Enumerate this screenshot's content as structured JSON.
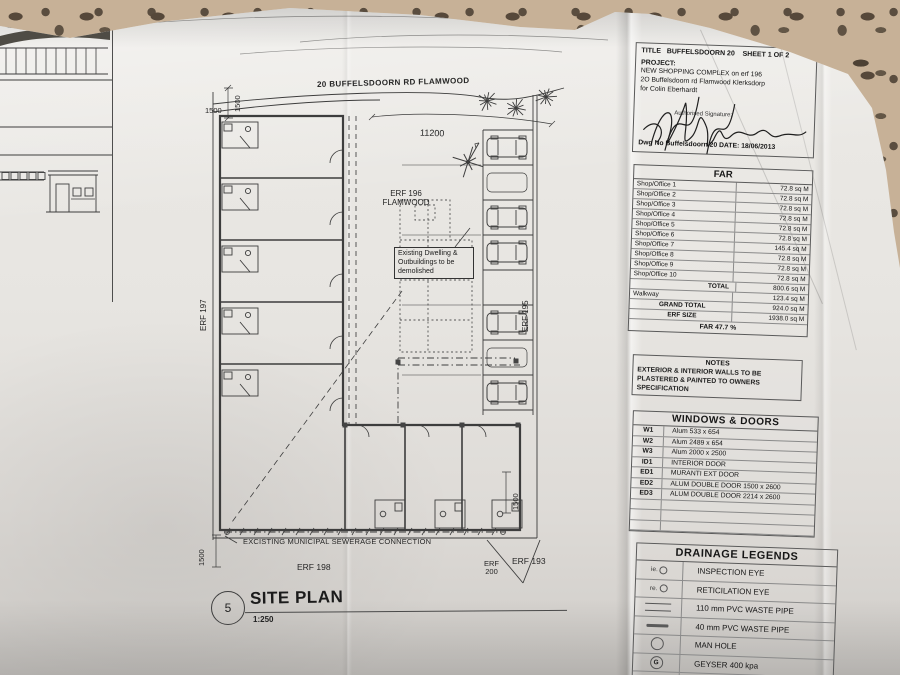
{
  "photo": {
    "handwritten_note": "910/6"
  },
  "plan": {
    "road_label": "20 BUFFELSDOORN RD FLAMWOOD",
    "dim_top": "11200",
    "dim_1500": "1500",
    "erf196_line1": "ERF 196",
    "erf196_line2": "FLAMWOOD",
    "erf197": "ERF 197",
    "erf195": "ERF 195",
    "erf198": "ERF 198",
    "erf200_line1": "ERF",
    "erf200_line2": "200",
    "erf193": "ERF 193",
    "demolish_lines": [
      "Existing Dwelling &",
      "Outbuildings to be",
      "demolished"
    ],
    "sewer_label": "EXCISTING MUNICIPAL SEWERAGE CONNECTION",
    "sheet_circle": "5",
    "title": "SITE PLAN",
    "scale": "1:250"
  },
  "title_block": {
    "title_line": "TITLE   BUFFELSDOORN 20    SHEET 1 OF 2",
    "project_label": "PROJECT:",
    "project_lines": [
      "NEW SHOPPING COMPLEX on erf 196",
      "2O Buffelsdoorn rd Flamwood  Klerksdorp",
      "for Colin Eberhardt"
    ],
    "auth_label": "Authorised Signature:",
    "dwg_line": "Dwg No Buffelsdoorn 20  DATE: 18/06/2013",
    "far": {
      "header": "FAR",
      "rows": [
        {
          "label": "Shop/Office 1",
          "value": "72.8 sq M",
          "style": "item"
        },
        {
          "label": "Shop/Office 2",
          "value": "72.8 sq M",
          "style": "item"
        },
        {
          "label": "Shop/Office 3",
          "value": "72.8 sq M",
          "style": "item"
        },
        {
          "label": "Shop/Office 4",
          "value": "72.8 sq M",
          "style": "item"
        },
        {
          "label": "Shop/Office 5",
          "value": "72.8 sq M",
          "style": "item"
        },
        {
          "label": "Shop/Office 6",
          "value": "72.8 sq M",
          "style": "item"
        },
        {
          "label": "Shop/Office 7",
          "value": "145.4 sq M",
          "style": "item"
        },
        {
          "label": "Shop/Office 8",
          "value": "72.8 sq M",
          "style": "item"
        },
        {
          "label": "Shop/Office 9",
          "value": "72.8 sq M",
          "style": "item"
        },
        {
          "label": "Shop/Office 10",
          "value": "72.8 sq M",
          "style": "item"
        },
        {
          "label": "TOTAL",
          "value": "800.6 sq M",
          "style": "total"
        },
        {
          "label": "Walkway",
          "value": "123.4 sq M",
          "style": "item"
        },
        {
          "label": "GRAND TOTAL",
          "value": "924.0 sq M",
          "style": "center"
        },
        {
          "label": "ERF SIZE",
          "value": "1938.0 sq M",
          "style": "center"
        }
      ],
      "footer": "FAR 47.7 %"
    },
    "notes": {
      "header": "NOTES",
      "lines": [
        "EXTERIOR & INTERIOR WALLS  TO BE",
        "PLASTERED & PAINTED TO OWNERS",
        "SPECIFICATION"
      ]
    },
    "windows_doors": {
      "header": "WINDOWS & DOORS",
      "rows": [
        {
          "code": "W1",
          "desc": "Alum 533 x 654"
        },
        {
          "code": "W2",
          "desc": "Alum 2489 x 654"
        },
        {
          "code": "W3",
          "desc": "Alum 2000 x 2500"
        },
        {
          "code": "ID1",
          "desc": "INTERIOR DOOR"
        },
        {
          "code": "ED1",
          "desc": "MURANTI EXT DOOR"
        },
        {
          "code": "ED2",
          "desc": "ALUM DOUBLE DOOR 1500 x 2600"
        },
        {
          "code": "ED3",
          "desc": "ALUM DOUBLE DOOR 2214 x 2600"
        }
      ],
      "empty_rows": 3
    },
    "drainage": {
      "header": "DRAINAGE LEGENDS",
      "rows": [
        {
          "sym": "ie",
          "sym_text": "ie.",
          "label": "INSPECTION EYE"
        },
        {
          "sym": "re",
          "sym_text": "re.",
          "label": "RETICILATION EYE"
        },
        {
          "sym": "dline",
          "sym_text": "",
          "label": "110 mm PVC WASTE PIPE"
        },
        {
          "sym": "sline",
          "sym_text": "",
          "label": "40 mm PVC WASTE PIPE"
        },
        {
          "sym": "manhole",
          "sym_text": "",
          "label": "MAN HOLE"
        },
        {
          "sym": "geyser",
          "sym_text": "G",
          "label": "GEYSER 400 kpa"
        },
        {
          "sym": "gulley",
          "sym_text": "",
          "label": "GULLEY"
        }
      ]
    }
  },
  "colors": {
    "paper": "#e7e5e1",
    "fabric": "#c7b197",
    "ink": "#3d3d3d"
  }
}
